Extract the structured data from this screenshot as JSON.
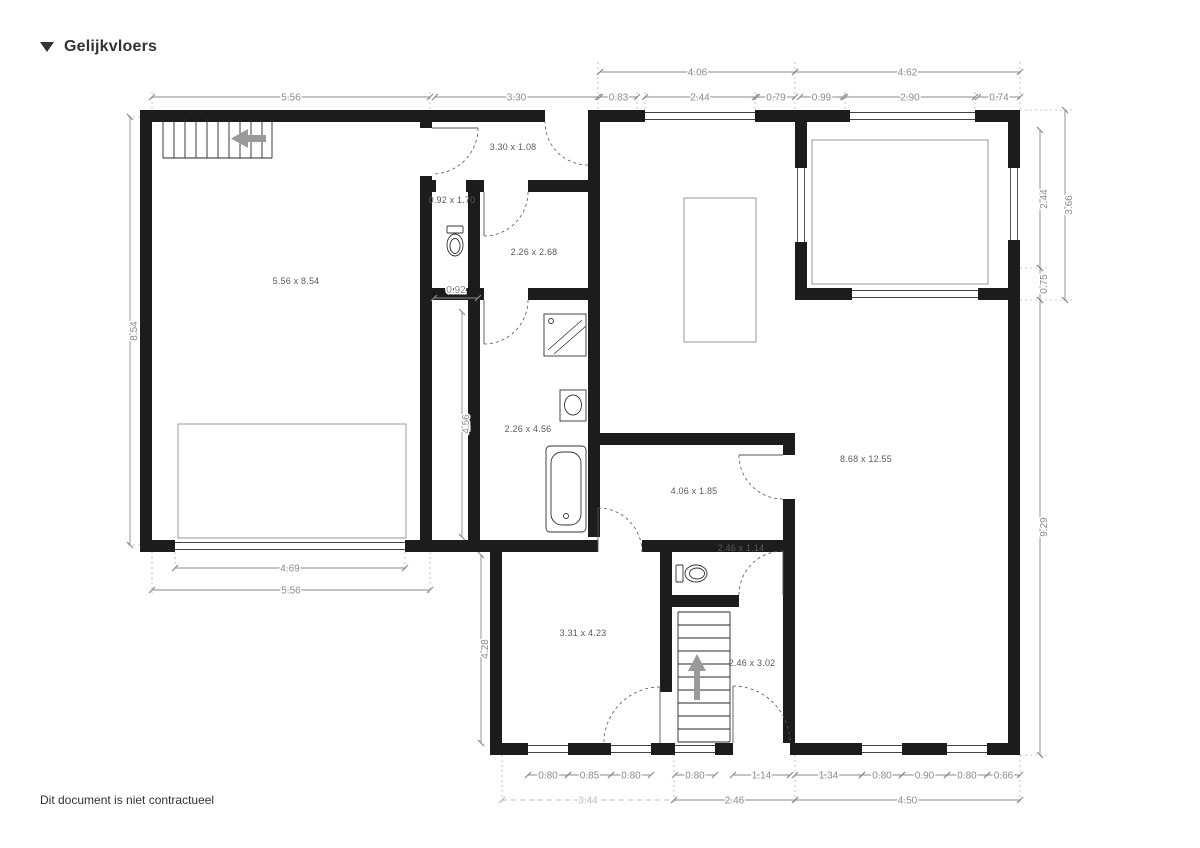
{
  "header": {
    "title": "Gelijkvloers"
  },
  "footer": {
    "disclaimer": "Dit document is niet contractueel"
  },
  "colors": {
    "wall": "#1c1c1c",
    "dimension": "#8a8a8a",
    "arrow": "#9a9a9a"
  },
  "floorplan": {
    "rooms": [
      "5.56 x 8.54",
      "3.30 x 1.08",
      "0.92 x 1.70",
      "2.26 x 2.68",
      "2.26 x 4.56",
      "4.06 x 1.85",
      "8.68 x 12.55",
      "2.46 x 1.14",
      "3.31 x 4.23",
      "2.46 x 3.02"
    ],
    "dims": {
      "top_upper": [
        "4.06",
        "4.62"
      ],
      "top": [
        "5.56",
        "3.30",
        "0.83",
        "2.44",
        "0.79",
        "0.99",
        "2.90",
        "0.74"
      ],
      "left": [
        "8.54"
      ],
      "center": [
        "0.92",
        "4.56",
        "4.28"
      ],
      "right": [
        "2.44",
        "0.75",
        "3.66",
        "9.29"
      ],
      "garage": [
        "4.69",
        "5.56"
      ],
      "bottom": [
        "0.80",
        "0.85",
        "0.80",
        "0.80",
        "1.14",
        "1.34",
        "0.80",
        "0.90",
        "0.80",
        "0.66"
      ],
      "bottom_totals": [
        "3.44",
        "2.46",
        "4.50"
      ]
    }
  }
}
